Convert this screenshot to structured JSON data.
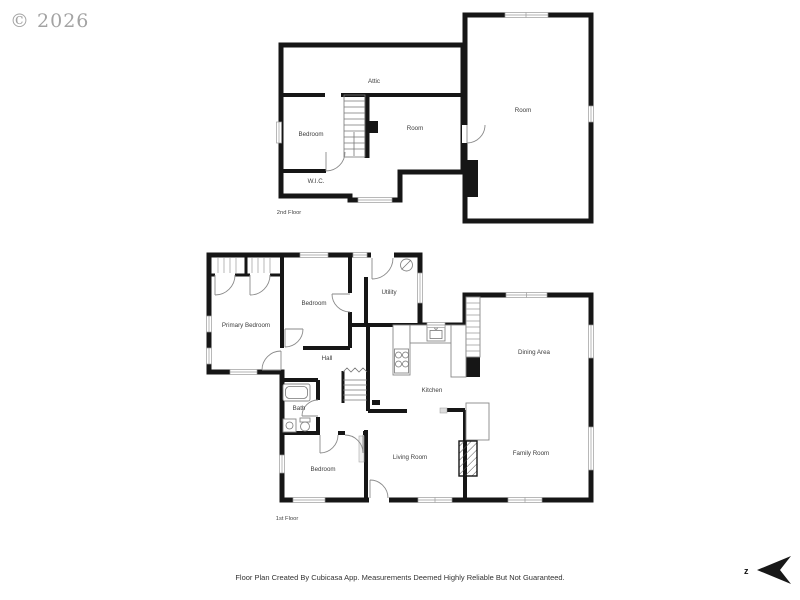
{
  "watermark": {
    "text": "© 2026"
  },
  "disclaimer": {
    "text": "Floor Plan Created By Cubicasa App. Measurements Deemed Highly Reliable But Not Guaranteed."
  },
  "compass": {
    "label": "z"
  },
  "colors": {
    "wall": "#161616",
    "label": "#3d3d3d",
    "watermark": "#a3a3a3",
    "window_line": "#9a9a9a"
  },
  "floor2": {
    "label": "2nd Floor",
    "rooms": {
      "attic": "Attic",
      "bedroom": "Bedroom",
      "room_left": "Room",
      "wic": "W.I.C.",
      "room_right": "Room"
    }
  },
  "floor1": {
    "label": "1st Floor",
    "rooms": {
      "primary_bedroom": "Primary Bedroom",
      "bedroom_top": "Bedroom",
      "utility": "Utility",
      "hall": "Hall",
      "bath": "Bath",
      "bedroom_bottom": "Bedroom",
      "living_room": "Living Room",
      "kitchen": "Kitchen",
      "dining_area": "Dining Area",
      "family_room": "Family Room"
    }
  }
}
